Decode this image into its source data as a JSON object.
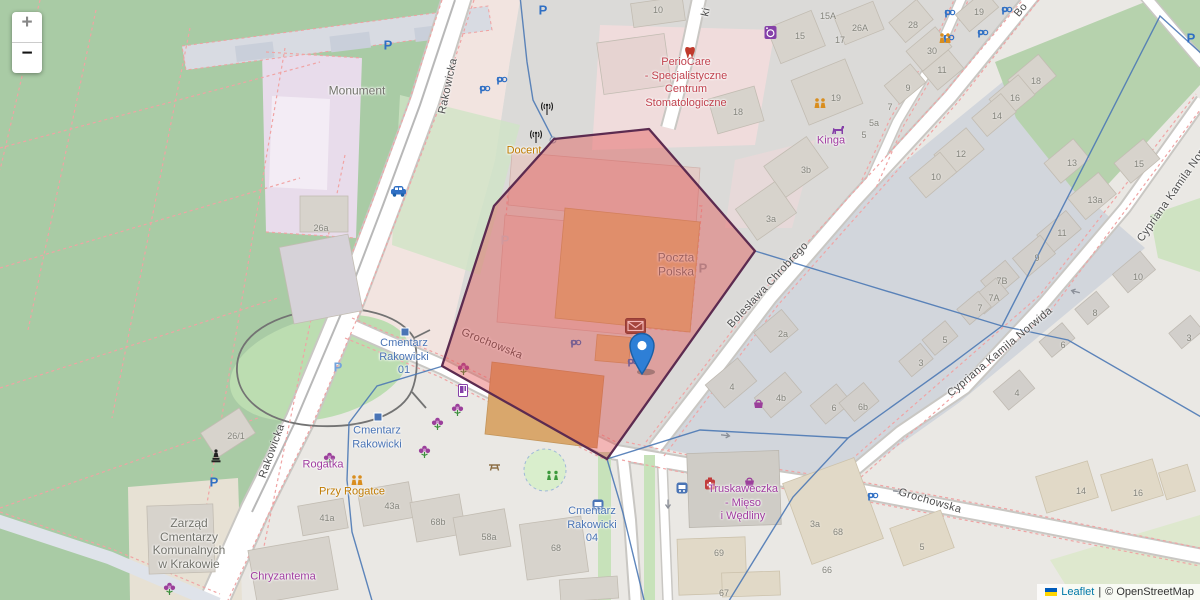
{
  "controls": {
    "zoom_in": "+",
    "zoom_out": "−"
  },
  "attribution": {
    "leaflet_link": "Leaflet",
    "separator": "|",
    "osm_link": "© OpenStreetMap"
  },
  "marker": {
    "kind": "post-office-marker"
  },
  "colors": {
    "highlight_fill": "#e24949",
    "highlight_border": "#5c2b50",
    "marker_blue": "#2e7fd6",
    "cemetery_green": "#a9cba5",
    "park_green": "#b6d2ad",
    "boundary_blue": "#4d79b5",
    "poi_red": "#c0424e",
    "poi_purple": "#a03ca0",
    "poi_orange": "#bf7a00",
    "transit_blue": "#4a74b5",
    "label_gray": "#73736c"
  },
  "street_labels": [
    {
      "text": "Rakowicka",
      "x": 448,
      "y": 86,
      "rot": -78
    },
    {
      "text": "Rakowicka",
      "x": 272,
      "y": 451,
      "rot": -70
    },
    {
      "text": "Grochowska",
      "x": 492,
      "y": 344,
      "rot": 22
    },
    {
      "text": "Grochowska",
      "x": 930,
      "y": 501,
      "rot": 16
    },
    {
      "text": "Bolesława Chrobrego",
      "x": 768,
      "y": 285,
      "rot": -47
    },
    {
      "text": "Cypriana Kamila Norwida",
      "x": 1000,
      "y": 352,
      "rot": -40
    },
    {
      "text": "Cypriana Kamila Norwida",
      "x": 1178,
      "y": 186,
      "rot": -55
    },
    {
      "text": "Bo",
      "x": 1021,
      "y": 10,
      "rot": -50
    },
    {
      "text": "ki",
      "x": 706,
      "y": 12,
      "rot": -77
    }
  ],
  "poi_labels": [
    {
      "lines": [
        "PerioCare",
        "- Specjalistyczne",
        "Centrum",
        "Stomatologiczne"
      ],
      "x": 686,
      "y": 83,
      "color": "red"
    },
    {
      "lines": [
        "Poczta",
        "Polska"
      ],
      "x": 676,
      "y": 265,
      "color": "gray"
    },
    {
      "lines": [
        "Monument"
      ],
      "x": 357,
      "y": 91,
      "color": "gray"
    },
    {
      "lines": [
        "Docent"
      ],
      "x": 524,
      "y": 151,
      "color": "orange"
    },
    {
      "lines": [
        "Kinga"
      ],
      "x": 831,
      "y": 141,
      "color": "purple"
    },
    {
      "lines": [
        "Cmentarz",
        "Rakowicki",
        "01"
      ],
      "x": 404,
      "y": 357,
      "color": "blue"
    },
    {
      "lines": [
        "Cmentarz",
        "Rakowicki"
      ],
      "x": 377,
      "y": 438,
      "color": "blue"
    },
    {
      "lines": [
        "Cmentarz",
        "Rakowicki",
        "04"
      ],
      "x": 592,
      "y": 525,
      "color": "blue"
    },
    {
      "lines": [
        "Rogatka"
      ],
      "x": 323,
      "y": 465,
      "color": "purple"
    },
    {
      "lines": [
        "Przy Rogatce"
      ],
      "x": 352,
      "y": 492,
      "color": "orange"
    },
    {
      "lines": [
        "Chryzantema"
      ],
      "x": 283,
      "y": 577,
      "color": "purple"
    },
    {
      "lines": [
        "Zarząd",
        "Cmentarzy",
        "Komunalnych",
        "w Krakowie"
      ],
      "x": 189,
      "y": 544,
      "color": "gray"
    },
    {
      "lines": [
        "Truskaweczka",
        "- Mięso",
        "i Wędliny"
      ],
      "x": 743,
      "y": 503,
      "color": "purple"
    }
  ],
  "house_numbers": [
    {
      "text": "26a",
      "x": 321,
      "y": 228
    },
    {
      "text": "26/1",
      "x": 236,
      "y": 436
    },
    {
      "text": "41a",
      "x": 327,
      "y": 518
    },
    {
      "text": "43a",
      "x": 392,
      "y": 506
    },
    {
      "text": "68b",
      "x": 438,
      "y": 522
    },
    {
      "text": "58a",
      "x": 489,
      "y": 537
    },
    {
      "text": "68",
      "x": 556,
      "y": 548
    },
    {
      "text": "69",
      "x": 719,
      "y": 553
    },
    {
      "text": "67",
      "x": 724,
      "y": 593
    },
    {
      "text": "66",
      "x": 827,
      "y": 570
    },
    {
      "text": "68",
      "x": 838,
      "y": 532
    },
    {
      "text": "3a",
      "x": 815,
      "y": 524
    },
    {
      "text": "5",
      "x": 922,
      "y": 547
    },
    {
      "text": "14",
      "x": 1081,
      "y": 491
    },
    {
      "text": "16",
      "x": 1138,
      "y": 493
    },
    {
      "text": "10",
      "x": 658,
      "y": 10
    },
    {
      "text": "15A",
      "x": 828,
      "y": 16
    },
    {
      "text": "26A",
      "x": 860,
      "y": 28
    },
    {
      "text": "17",
      "x": 840,
      "y": 40
    },
    {
      "text": "15",
      "x": 800,
      "y": 36
    },
    {
      "text": "18",
      "x": 738,
      "y": 112
    },
    {
      "text": "19",
      "x": 836,
      "y": 98
    },
    {
      "text": "7",
      "x": 890,
      "y": 107
    },
    {
      "text": "5a",
      "x": 874,
      "y": 123
    },
    {
      "text": "5",
      "x": 864,
      "y": 135
    },
    {
      "text": "3b",
      "x": 806,
      "y": 170
    },
    {
      "text": "3a",
      "x": 771,
      "y": 219
    },
    {
      "text": "28",
      "x": 913,
      "y": 25
    },
    {
      "text": "30",
      "x": 932,
      "y": 51
    },
    {
      "text": "11",
      "x": 942,
      "y": 70
    },
    {
      "text": "9",
      "x": 908,
      "y": 88
    },
    {
      "text": "19",
      "x": 979,
      "y": 12
    },
    {
      "text": "18",
      "x": 1036,
      "y": 81
    },
    {
      "text": "16",
      "x": 1015,
      "y": 98
    },
    {
      "text": "14",
      "x": 997,
      "y": 116
    },
    {
      "text": "12",
      "x": 961,
      "y": 154
    },
    {
      "text": "10",
      "x": 936,
      "y": 177
    },
    {
      "text": "13",
      "x": 1072,
      "y": 163
    },
    {
      "text": "15",
      "x": 1139,
      "y": 164
    },
    {
      "text": "13a",
      "x": 1095,
      "y": 200
    },
    {
      "text": "11",
      "x": 1062,
      "y": 233
    },
    {
      "text": "9",
      "x": 1037,
      "y": 258
    },
    {
      "text": "7B",
      "x": 1002,
      "y": 281
    },
    {
      "text": "7A",
      "x": 994,
      "y": 298
    },
    {
      "text": "7",
      "x": 980,
      "y": 308
    },
    {
      "text": "10",
      "x": 1138,
      "y": 277
    },
    {
      "text": "8",
      "x": 1095,
      "y": 313
    },
    {
      "text": "6",
      "x": 1063,
      "y": 345
    },
    {
      "text": "3",
      "x": 1189,
      "y": 338
    },
    {
      "text": "4",
      "x": 1017,
      "y": 393
    },
    {
      "text": "2a",
      "x": 783,
      "y": 334
    },
    {
      "text": "4",
      "x": 732,
      "y": 387
    },
    {
      "text": "4b",
      "x": 781,
      "y": 398
    },
    {
      "text": "6",
      "x": 834,
      "y": 408
    },
    {
      "text": "6b",
      "x": 863,
      "y": 407
    },
    {
      "text": "5",
      "x": 945,
      "y": 340
    },
    {
      "text": "3",
      "x": 921,
      "y": 363
    }
  ],
  "map_icons": [
    {
      "t": "parking",
      "x": 388,
      "y": 45
    },
    {
      "t": "parking",
      "x": 543,
      "y": 10
    },
    {
      "t": "parking",
      "x": 338,
      "y": 367,
      "c": "#74a4dc"
    },
    {
      "t": "parking",
      "x": 214,
      "y": 482
    },
    {
      "t": "parking",
      "x": 505,
      "y": 240,
      "c": "#c7cfd6"
    },
    {
      "t": "parking",
      "x": 703,
      "y": 268,
      "c": "#9aa0a6"
    },
    {
      "t": "parking",
      "x": 1191,
      "y": 38
    },
    {
      "t": "parking-bike",
      "x": 488,
      "y": 93
    },
    {
      "t": "parking-bike",
      "x": 505,
      "y": 84
    },
    {
      "t": "parking-bike",
      "x": 579,
      "y": 347
    },
    {
      "t": "parking-bike",
      "x": 636,
      "y": 366
    },
    {
      "t": "parking-bike",
      "x": 876,
      "y": 500
    },
    {
      "t": "parking-bike",
      "x": 953,
      "y": 17
    },
    {
      "t": "parking-bike",
      "x": 1010,
      "y": 14
    },
    {
      "t": "parking-bike",
      "x": 986,
      "y": 37
    },
    {
      "t": "parking-bike",
      "x": 952,
      "y": 42
    },
    {
      "t": "car",
      "x": 390,
      "y": 185
    },
    {
      "t": "tram-stop",
      "x": 405,
      "y": 332
    },
    {
      "t": "tram-stop",
      "x": 378,
      "y": 417
    },
    {
      "t": "bus-stop",
      "x": 592,
      "y": 499
    },
    {
      "t": "bus-stop",
      "x": 676,
      "y": 482
    },
    {
      "t": "flower",
      "x": 457,
      "y": 362
    },
    {
      "t": "flower",
      "x": 451,
      "y": 403
    },
    {
      "t": "flower",
      "x": 431,
      "y": 417
    },
    {
      "t": "flower",
      "x": 418,
      "y": 445
    },
    {
      "t": "flower",
      "x": 323,
      "y": 452
    },
    {
      "t": "flower",
      "x": 163,
      "y": 582
    },
    {
      "t": "basket",
      "x": 743,
      "y": 476
    },
    {
      "t": "basket",
      "x": 752,
      "y": 398
    },
    {
      "t": "firstaid",
      "x": 704,
      "y": 477
    },
    {
      "t": "tooth",
      "x": 684,
      "y": 46
    },
    {
      "t": "laundry",
      "x": 764,
      "y": 25
    },
    {
      "t": "dog",
      "x": 831,
      "y": 124
    },
    {
      "t": "people",
      "x": 938,
      "y": 33
    },
    {
      "t": "people",
      "x": 813,
      "y": 98
    },
    {
      "t": "people",
      "x": 350,
      "y": 475
    },
    {
      "t": "statue",
      "x": 211,
      "y": 449
    },
    {
      "t": "antenna",
      "x": 541,
      "y": 102
    },
    {
      "t": "antenna",
      "x": 530,
      "y": 130
    },
    {
      "t": "vending",
      "x": 458,
      "y": 384
    },
    {
      "t": "play",
      "x": 545,
      "y": 470
    },
    {
      "t": "picnic",
      "x": 488,
      "y": 462
    },
    {
      "t": "envelope",
      "x": 625,
      "y": 318
    },
    {
      "t": "arrow",
      "x": 662,
      "y": 500,
      "r": 90
    },
    {
      "t": "arrow",
      "x": 720,
      "y": 431,
      "r": 8
    },
    {
      "t": "arrow",
      "x": 892,
      "y": 487,
      "r": 8
    },
    {
      "t": "arrow",
      "x": 1069,
      "y": 287,
      "r": 195
    }
  ]
}
